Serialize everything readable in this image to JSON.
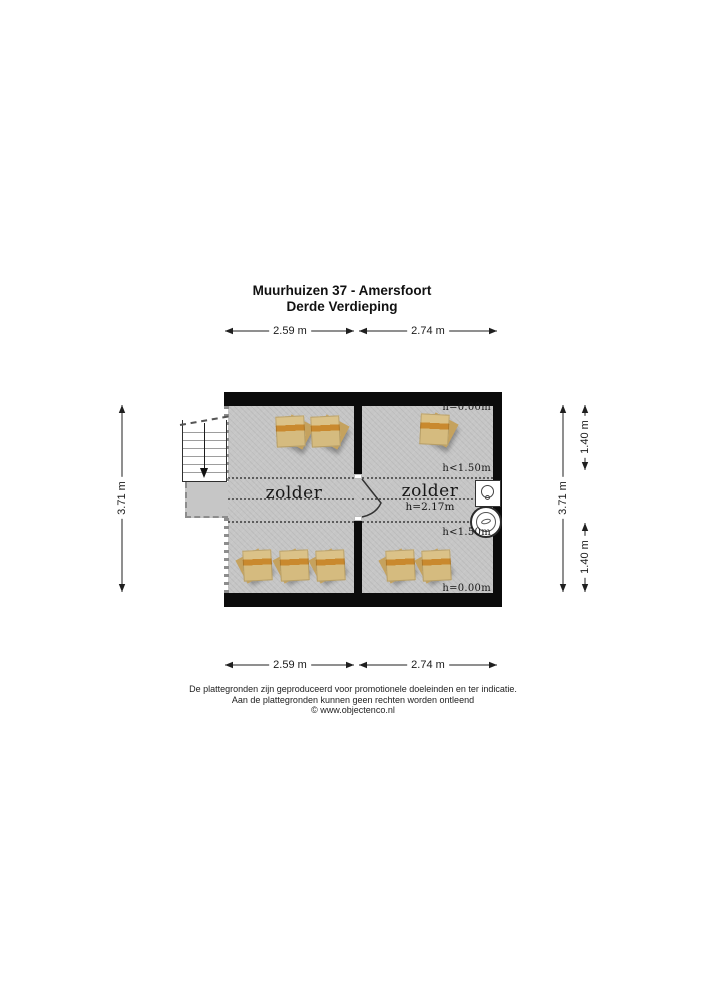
{
  "title": {
    "line1": "Muurhuizen 37 - Amersfoort",
    "line2": "Derde Verdieping"
  },
  "dimensions": {
    "top_left": "2.59 m",
    "top_right": "2.74 m",
    "bottom_left": "2.59 m",
    "bottom_right": "2.74 m",
    "left_side": "3.71 m",
    "right_outer": "3.71 m",
    "right_upper": "1.40 m",
    "right_lower": "1.40 m"
  },
  "rooms": {
    "left": {
      "label": "zolder"
    },
    "right": {
      "label": "zolder",
      "ceiling_height": "h=2.17m"
    }
  },
  "height_markers": {
    "top": "h=0.00m",
    "upper": "h<1.50m",
    "lower": "h<1.50m",
    "bottom": "h=0.00m"
  },
  "footer": {
    "line1": "De plattegronden zijn geproduceerd voor promotionele doeleinden en ter indicatie.",
    "line2": "Aan de plattegronden kunnen geen rechten worden ontleend",
    "line3": "© www.objectenco.nl"
  },
  "colors": {
    "wall": "#0b0b0b",
    "floor": "#c6c6c6",
    "skylight": "#dbc288",
    "skylight_stripe": "#c9892e"
  }
}
